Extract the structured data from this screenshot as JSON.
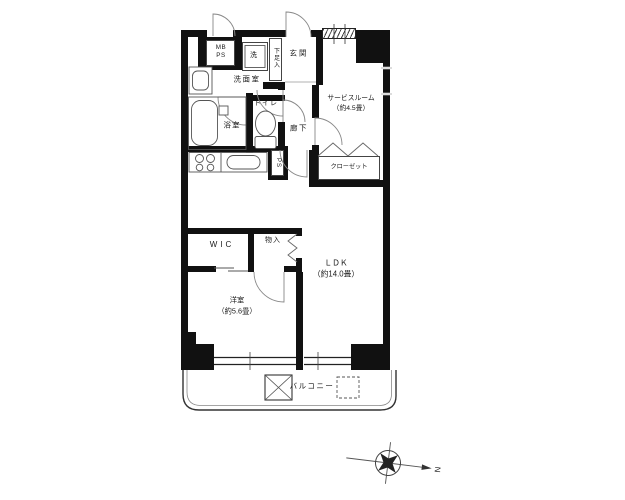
{
  "colors": {
    "wall": "#111111",
    "line": "#555555",
    "background": "#ffffff"
  },
  "labels": {
    "meter_box": "MB\nPS",
    "washer": "洗",
    "shoe_cabinet": "下足入",
    "entrance": "玄関",
    "service_room": "サービスルーム\n（約4.5畳）",
    "washroom": "洗面室",
    "bathroom": "浴室",
    "toilet": "トイレ",
    "hallway": "廊下",
    "closet": "クローゼット",
    "pipe_space": "PS",
    "walk_in_closet": "WIC",
    "storage": "物入",
    "ldk": "ＬＤＫ\n（約14.0畳）",
    "western_room": "洋室\n（約5.6畳）",
    "balcony": "バルコニー",
    "compass_north": "N"
  }
}
